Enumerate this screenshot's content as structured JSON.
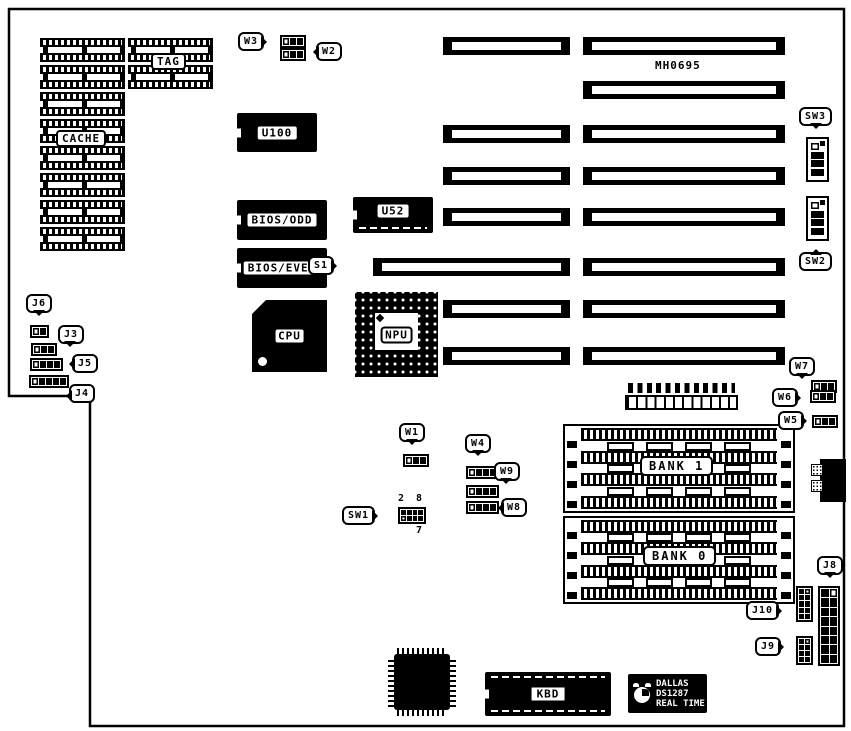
{
  "diagram": {
    "board_number": "MH0695",
    "chips": {
      "cache": "CACHE",
      "tag": "TAG",
      "u100": "U100",
      "bios_odd": "BIOS/ODD",
      "u52": "U52",
      "bios_even": "BIOS/EVEN",
      "cpu": "CPU",
      "npu": "NPU",
      "kbd": "KBD"
    },
    "memory": {
      "bank1": "BANK 1",
      "bank0": "BANK 0"
    },
    "slot": {
      "s1": "S1"
    },
    "jumpers": {
      "w1": "W1",
      "w2": "W2",
      "w3": "W3",
      "w4": "W4",
      "w5": "W5",
      "w6": "W6",
      "w7": "W7",
      "w8": "W8",
      "w9": "W9"
    },
    "connectors": {
      "j3": "J3",
      "j4": "J4",
      "j5": "J5",
      "j6": "J6",
      "j8": "J8",
      "j9": "J9",
      "j10": "J10"
    },
    "switches": {
      "sw1": "SW1",
      "sw2": "SW2",
      "sw3": "SW3",
      "sw1_markings": {
        "top_left": "2",
        "top_right": "8",
        "bottom_right": "7"
      }
    },
    "rtc": {
      "line1": "DALLAS",
      "line2": "DS1287",
      "line3": "REAL TIME"
    },
    "colors": {
      "ink": "#000000",
      "paper": "#ffffff"
    }
  }
}
